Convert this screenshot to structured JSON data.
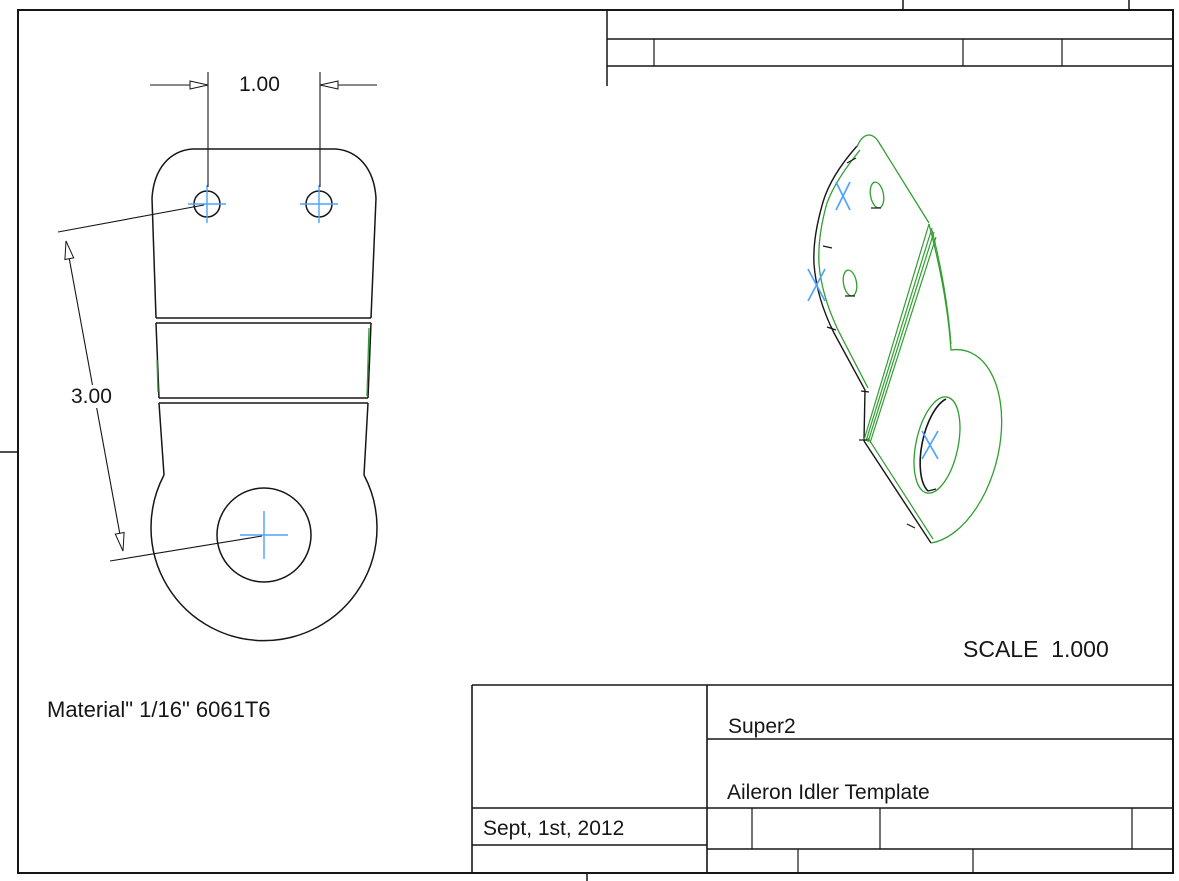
{
  "sheet": {
    "scale_label": "SCALE  1.000",
    "material_note": "Material\" 1/16\" 6061T6"
  },
  "dimensions": {
    "hole_spacing": "1.00",
    "hole_distance": "3.00"
  },
  "title_block": {
    "project": "Super2",
    "drawing_title": "Aileron Idler Template",
    "date": "Sept, 1st, 2012"
  },
  "colors": {
    "line": "#161616",
    "green": "#2f9e2f",
    "blue": "#4da3ff",
    "paper": "#ffffff"
  },
  "markers": {
    "center_mark": "crosshair",
    "iso_datum_mark": "X"
  }
}
